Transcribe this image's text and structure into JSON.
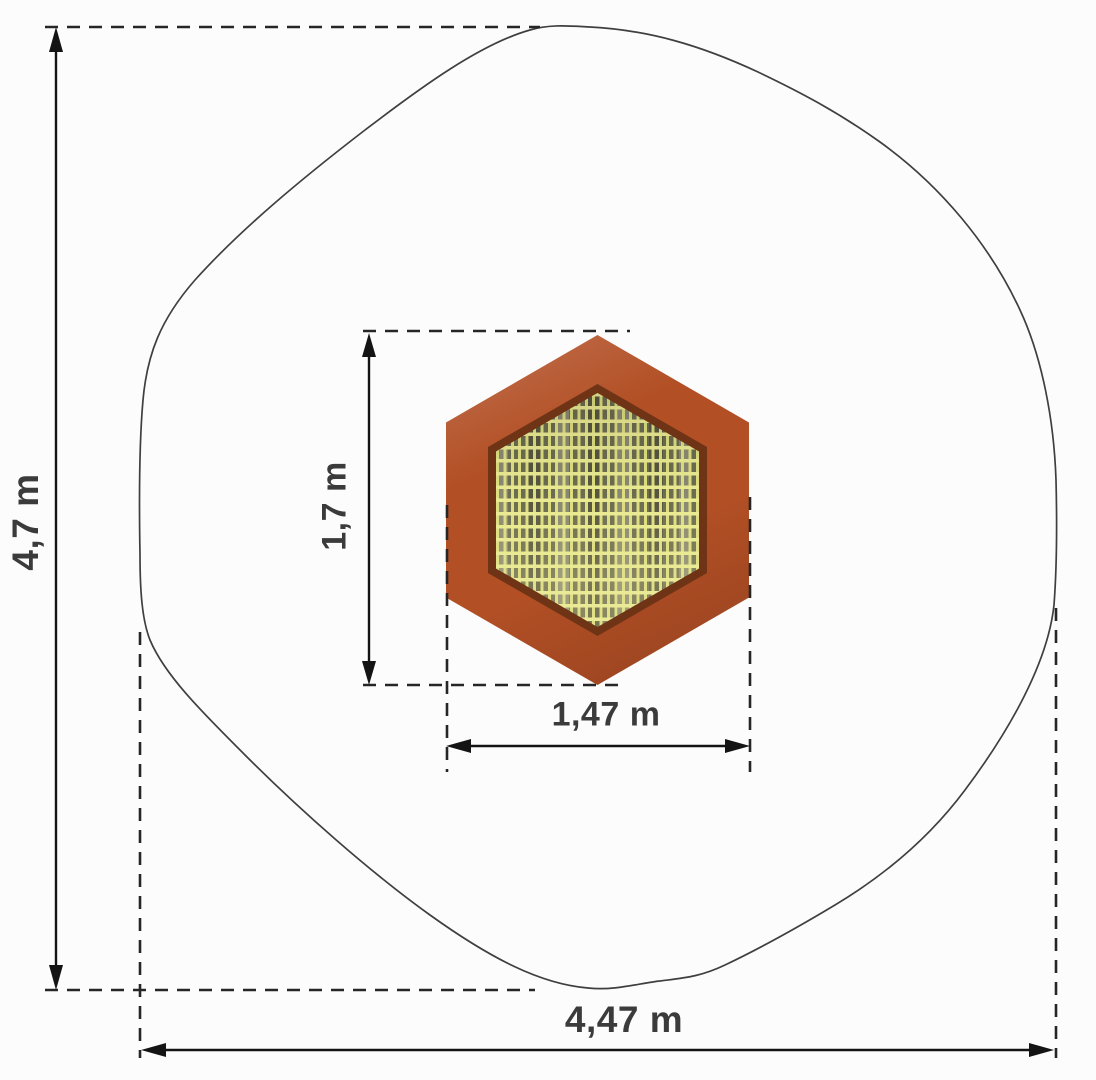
{
  "diagram": {
    "labels": {
      "overall_height": "4,7 m",
      "overall_width": "4,47 m",
      "mat_height": "1,7 m",
      "mat_width": "1,47 m"
    },
    "colors": {
      "background": "#fcfcfc",
      "outline": "#3f3f3f",
      "dimension_line": "#141414",
      "frame": "#b24f25",
      "frame_edge": "#6f3316",
      "mesh_dark": "#6c6c50",
      "mesh_light": "#eaea92",
      "label_text": "#3b3b3b"
    }
  }
}
